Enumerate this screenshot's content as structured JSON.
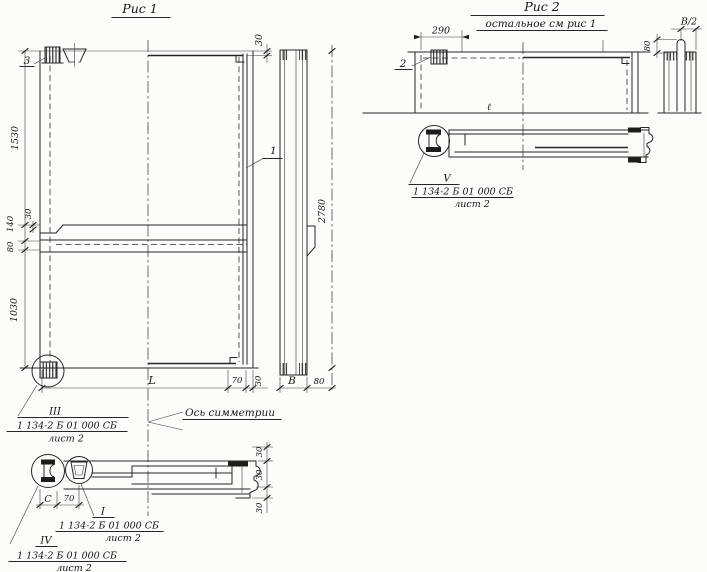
{
  "sheet": {
    "background": "#fcfcf9",
    "ink": "#262626"
  },
  "fig1": {
    "title": "Рис 1",
    "axis_of_symmetry_label": "Ось симметрии",
    "part_marks": {
      "item_1": "1",
      "item_3": "3"
    },
    "dimensions": {
      "height_top": "1530",
      "groove_depth": "140",
      "groove_bevel": "30",
      "groove_step": "80",
      "height_bottom": "1030",
      "top_edge_offset": "30",
      "length": "L",
      "bottom_70": "70",
      "bottom_30": "30",
      "thickness": "В",
      "edge_80": "80",
      "overall_height": "2780",
      "section_30_top": "30",
      "section_30_mid": "30",
      "section_30_bottom": "30",
      "section_c": "С",
      "section_70": "70"
    },
    "details": {
      "detail_iii": {
        "mark": "III",
        "doc": "1 134-2 Б 01 000 СБ",
        "sheet_ref": "лист 2"
      },
      "detail_i": {
        "mark": "I",
        "doc": "1 134-2 Б 01 000 СБ",
        "sheet_ref": "лист 2"
      },
      "detail_iv": {
        "mark": "IV",
        "doc": "1 134-2 Б 01 000 СБ",
        "sheet_ref": "лист 2"
      }
    }
  },
  "fig2": {
    "title": "Рис 2",
    "subtitle": "остальное см рис 1",
    "part_marks": {
      "item_2": "2"
    },
    "length_mark": "ℓ",
    "dimensions": {
      "anchor_offset": "290",
      "half_thickness": "В/2",
      "tab_height": "80"
    },
    "details": {
      "detail_v": {
        "mark": "V",
        "doc": "1 134-2 Б 01 000 СБ",
        "sheet_ref": "лист 2"
      }
    }
  }
}
